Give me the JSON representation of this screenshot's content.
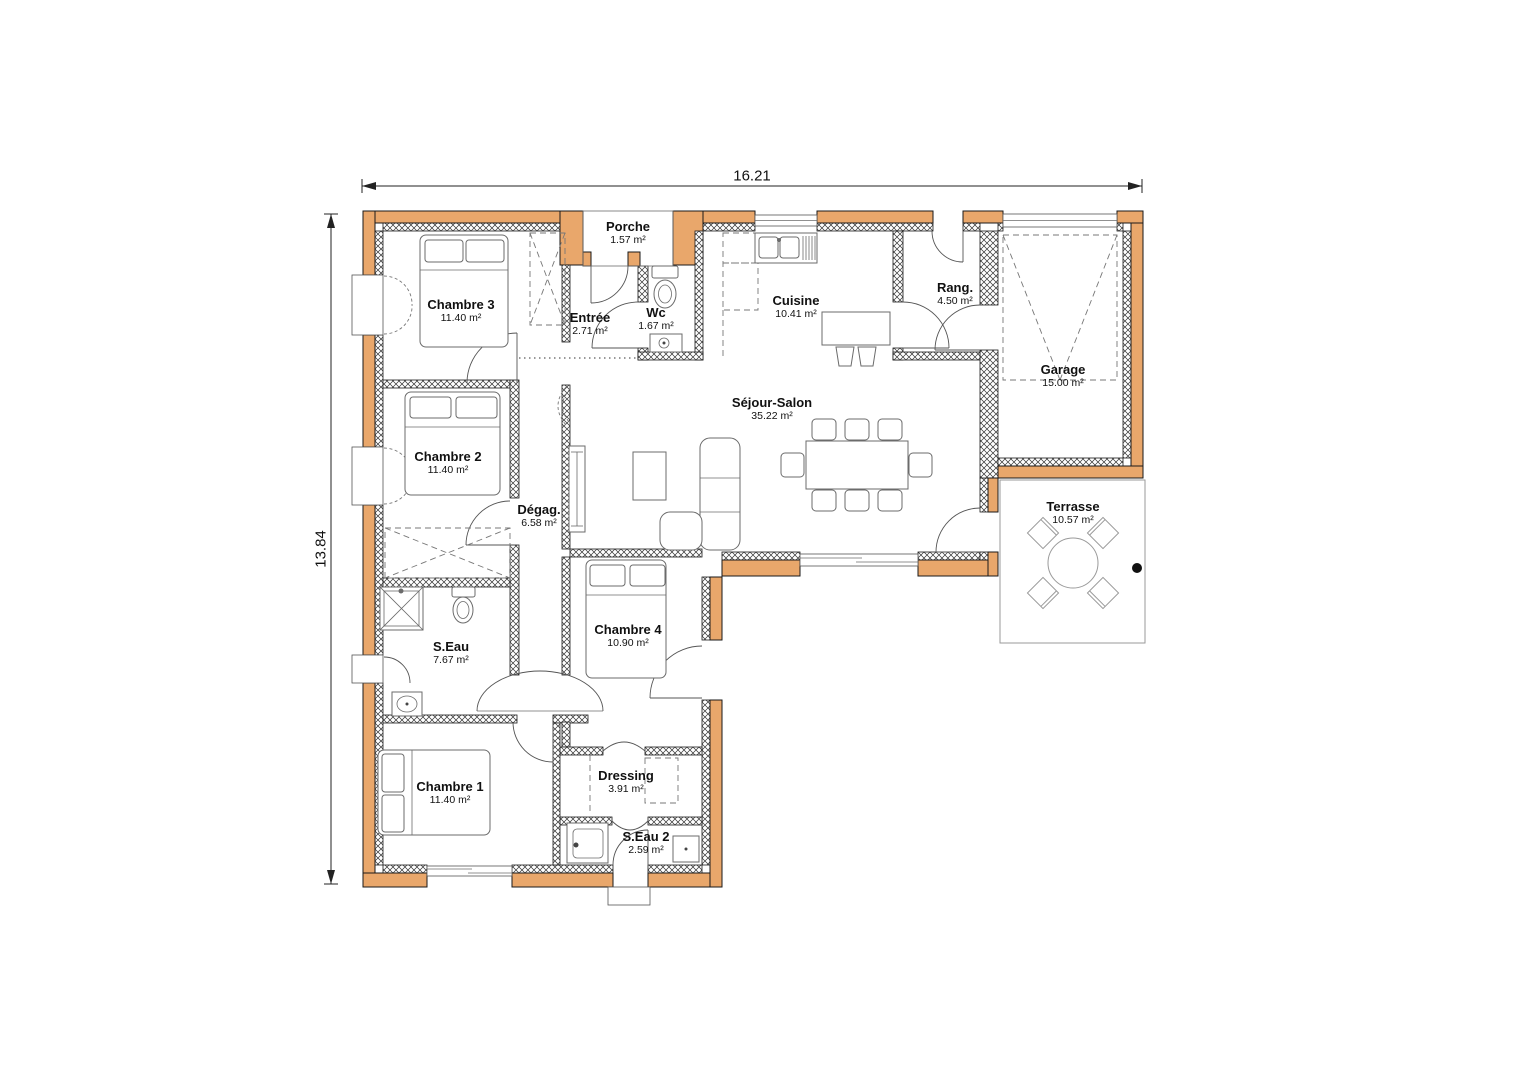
{
  "dimensions": {
    "width_m": "16.21",
    "height_m": "13.84"
  },
  "rooms": [
    {
      "id": "porche",
      "name": "Porche",
      "area": "1.57 m²"
    },
    {
      "id": "chambre3",
      "name": "Chambre 3",
      "area": "11.40 m²"
    },
    {
      "id": "entree",
      "name": "Entrée",
      "area": "2.71 m²"
    },
    {
      "id": "wc",
      "name": "Wc",
      "area": "1.67 m²"
    },
    {
      "id": "cuisine",
      "name": "Cuisine",
      "area": "10.41 m²"
    },
    {
      "id": "rang",
      "name": "Rang.",
      "area": "4.50 m²"
    },
    {
      "id": "garage",
      "name": "Garage",
      "area": "15.00 m²"
    },
    {
      "id": "chambre2",
      "name": "Chambre 2",
      "area": "11.40 m²"
    },
    {
      "id": "degag",
      "name": "Dégag.",
      "area": "6.58 m²"
    },
    {
      "id": "sejour",
      "name": "Séjour-Salon",
      "area": "35.22 m²"
    },
    {
      "id": "seau",
      "name": "S.Eau",
      "area": "7.67 m²"
    },
    {
      "id": "chambre4",
      "name": "Chambre 4",
      "area": "10.90 m²"
    },
    {
      "id": "terrasse",
      "name": "Terrasse",
      "area": "10.57 m²"
    },
    {
      "id": "chambre1",
      "name": "Chambre 1",
      "area": "11.40 m²"
    },
    {
      "id": "dressing",
      "name": "Dressing",
      "area": "3.91 m²"
    },
    {
      "id": "seau2",
      "name": "S.Eau 2",
      "area": "2.59 m²"
    }
  ],
  "colors": {
    "wall_fill": "#E9A76B",
    "wall_outline": "#1A1A1A",
    "furniture_line": "#6B6B6B",
    "terrace_outline": "#9A9A9A",
    "dimension_line": "#222222"
  }
}
